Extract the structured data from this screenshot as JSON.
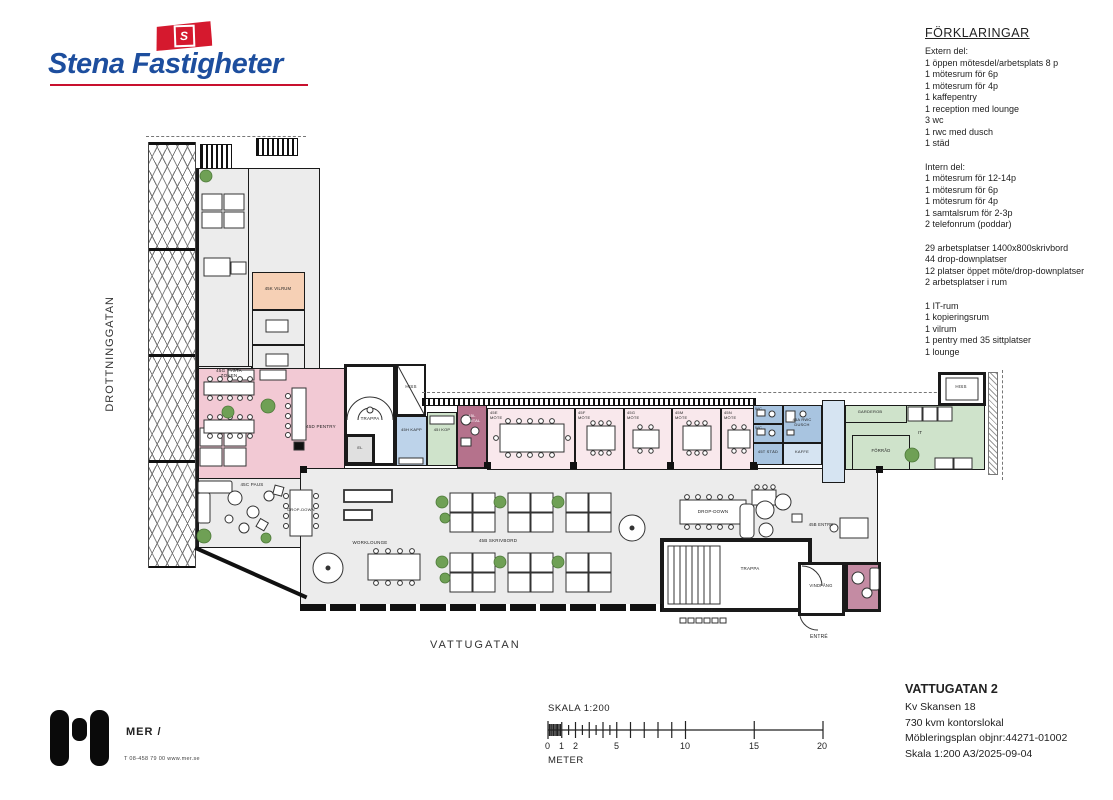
{
  "brand": {
    "name": "Stena Fastigheter",
    "flag_letter": "S",
    "blue": "#1d4e9e",
    "red": "#d5192e"
  },
  "legend": {
    "title": "FÖRKLARINGAR",
    "extern": [
      "Extern del:",
      "1 öppen mötesdel/arbetsplats 8 p",
      "1 mötesrum för 6p",
      "1 mötesrum  för 4p",
      "1 kaffepentry",
      "1 reception med lounge",
      "3 wc",
      "1 rwc med dusch",
      "1 städ"
    ],
    "intern": [
      "Intern del:",
      "1 mötesrum för 12-14p",
      "1 mötesrum för 6p",
      "1 mötesrum  för 4p",
      "1 samtalsrum för 2-3p",
      "2 telefonrum (poddar)"
    ],
    "platser": [
      "29 arbetsplatser 1400x800skrivbord",
      "44 drop-downplatser",
      "12 platser öppet möte/drop-downplatser",
      "2 arbetsplatser i rum"
    ],
    "ovrigt": [
      "1 IT-rum",
      "1 kopieringsrum",
      "1 vilrum",
      "1 pentry med 35 sittplatser",
      "1 lounge"
    ]
  },
  "streets": {
    "left": "DROTTNINGGATAN",
    "bottom": "VATTUGATAN"
  },
  "plan": {
    "rooms": {
      "tysta": "45G TYSTA ZONEN",
      "vilrum": "45K VILRUM",
      "pentry": "45D PENTRY",
      "paus": "45C PAUS",
      "trappa_w": "TRAPPA",
      "el": "EL",
      "hiss_w": "HISS",
      "kapp": "45H KAPP",
      "kop": "45I KOP",
      "samtal": "45L SAMTAL",
      "mote": [
        "45E MÖTE",
        "45F MÖTE",
        "45G MÖTE",
        "45M MÖTE",
        "45N MÖTE"
      ],
      "wc_a": "WC",
      "wc_b": "WC",
      "stad": "45T STÄD",
      "rwc": "45A RWC DUSCH",
      "kaffe": "KAFFE",
      "garderob": "GARDEROB",
      "it": "IT",
      "forrad": "FÖRRÅD",
      "hiss_e": "HISS",
      "worklounge": "WORKLOUNGE",
      "skrivbord": "45B SKRIVBORD",
      "dropdown_a": "DROP-DOWN",
      "dropdown_b": "DROP-DOWN",
      "entre_inner": "45B ENTRE",
      "trappa_e": "TRAPPA",
      "sittfonster": "SITTFÖNSTRET",
      "vindfang": "VINDFÅNG",
      "entre_outer": "ENTRÉ"
    },
    "colors": {
      "floor": "#ececec",
      "pentry": "#f2c9d4",
      "mote": "#f9e8ec",
      "samtal": "#b5728c",
      "vilrum": "#f6d0b5",
      "wc": "#a8c4e0",
      "corridor": "#d6e4f2",
      "green": "#cfe3cb",
      "plant": "#6fa055"
    }
  },
  "scalebar": {
    "title": "SKALA 1:200",
    "unit": "METER",
    "ticks": [
      "0",
      "1",
      "2",
      "5",
      "10",
      "15",
      "20"
    ]
  },
  "titleblock": {
    "title": "VATTUGATAN 2",
    "line1": "Kv Skansen 18",
    "line2": "730 kvm kontorslokal",
    "line3": "Möbleringsplan objnr:44271-01002",
    "line4": "Skala 1:200 A3/2025-09-04"
  },
  "mer": {
    "name": "MER /",
    "contact": "T 08-458 79 00   www.mer.se"
  }
}
